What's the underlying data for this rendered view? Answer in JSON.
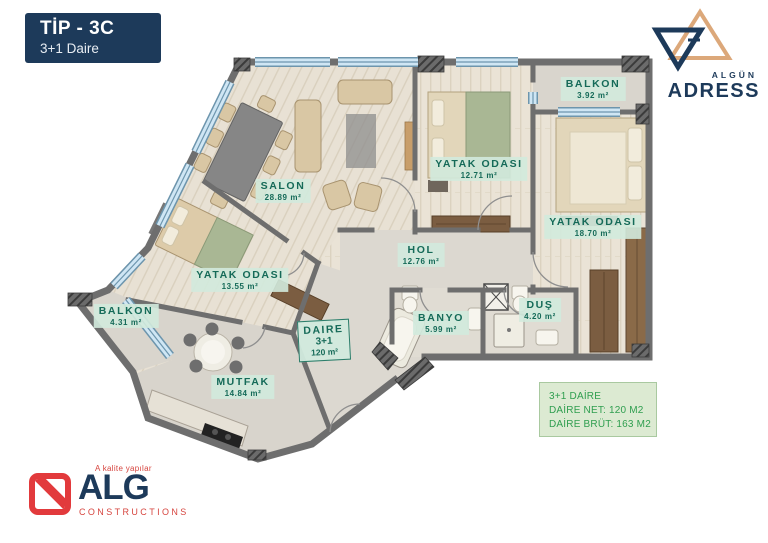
{
  "title_box": {
    "line1": "TİP - 3C",
    "line2": "3+1 Daire"
  },
  "brand_top": {
    "name_small": "ALGÜN",
    "name_large": "ADRESS"
  },
  "brand_bottom": {
    "tagline": "A kalite yapılar",
    "name": "ALG",
    "subtitle": "CONSTRUCTIONS"
  },
  "plan": {
    "rooms": [
      {
        "name": "SALON",
        "area": "28.89 m²"
      },
      {
        "name": "YATAK ODASI",
        "area": "12.71 m²"
      },
      {
        "name": "BALKON",
        "area": "3.92 m²"
      },
      {
        "name": "YATAK ODASI",
        "area": "18.70 m²"
      },
      {
        "name": "HOL",
        "area": "12.76 m²"
      },
      {
        "name": "YATAK ODASI",
        "area": "13.55 m²"
      },
      {
        "name": "BALKON",
        "area": "4.31 m²"
      },
      {
        "name": "MUTFAK",
        "area": "14.84 m²"
      },
      {
        "name": "BANYO",
        "area": "5.99 m²"
      },
      {
        "name": "DUŞ",
        "area": "4.20 m²"
      }
    ],
    "unit_tag": {
      "line1": "DAIRE",
      "line2": "3+1",
      "line3": "120 m²"
    }
  },
  "info_box": {
    "line1": "3+1 DAİRE",
    "line2": "DAİRE NET: 120 M2",
    "line3": "DAİRE BRÜT: 163 M2"
  },
  "colors": {
    "navy": "#1d3a5a",
    "brand_tan": "#dca87a",
    "brand_red": "#e23a3c",
    "label_text_green": "#156a58",
    "label_bg_green": "#d2ecdf",
    "info_text_green": "#2f9e4f",
    "info_bg_green": "#dcead2",
    "wall_gray": "#6e6e6e",
    "window_blue": "#cfe6f4",
    "floor_wood": "#eae3d6"
  }
}
